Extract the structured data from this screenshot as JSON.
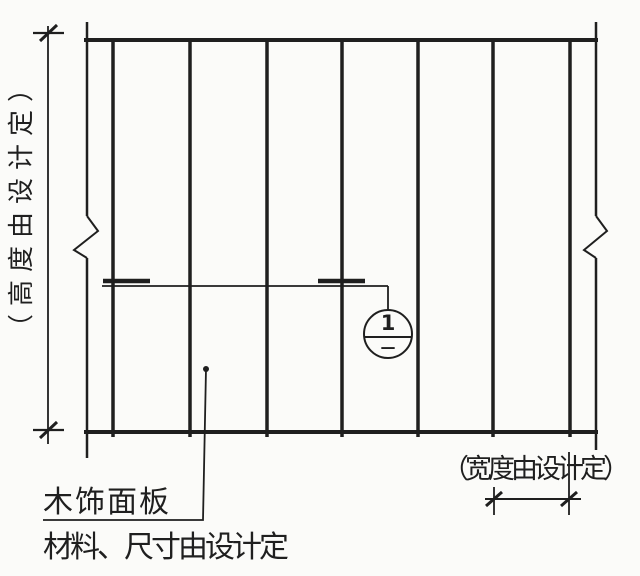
{
  "drawing": {
    "height_note": "（高度由设计定）",
    "width_note": "（宽度由设计定）",
    "panel_label": "木饰面板",
    "panel_note": "材料、尺寸由设计定",
    "callout": {
      "number": "1",
      "sheet": "—"
    }
  },
  "colors": {
    "ink": "#1f1f1f",
    "paper": "#fbfbf9"
  },
  "geometry": {
    "panel": {
      "left": 87,
      "top": 40,
      "right": 596,
      "bottom": 432
    },
    "joint_x": [
      113,
      190,
      267,
      342,
      418,
      493,
      570
    ]
  }
}
